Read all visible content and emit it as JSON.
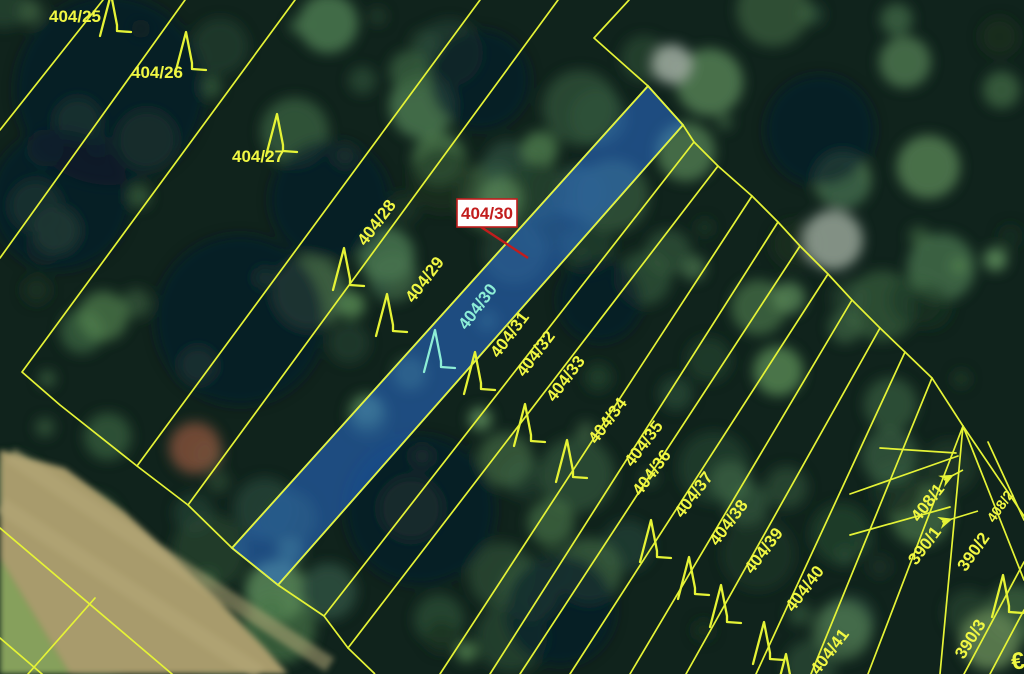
{
  "map": {
    "kind": "cadastral-parcel-overlay-on-aerial-imagery",
    "line_color": "#e5f336",
    "label_color": "#f0f743",
    "highlight_label_color": "#8deed6",
    "callout_color": "#c21d1d"
  },
  "callout": {
    "text": "404/30",
    "box": {
      "x": 457,
      "y": 199,
      "w": 60,
      "h": 28
    },
    "leader": [
      481,
      227,
      528,
      258
    ],
    "bg": "#ffffff",
    "border_color": "#c21d1d",
    "text_color": "#c21d1d"
  },
  "highlight_parcel": {
    "id": "404/30",
    "polygon": [
      [
        648,
        86
      ],
      [
        683,
        125
      ],
      [
        278,
        585
      ],
      [
        232,
        548
      ]
    ],
    "fill": "rgba(45,115,220,0.52)",
    "stroke": "#a8e4f0"
  },
  "parcel_labels": [
    {
      "text": "404/25",
      "x": 75,
      "y": 22,
      "rot": 0
    },
    {
      "text": "404/26",
      "x": 157,
      "y": 78,
      "rot": 0
    },
    {
      "text": "404/27",
      "x": 258,
      "y": 162,
      "rot": 0
    },
    {
      "text": "404/28",
      "x": 381,
      "y": 226,
      "rot": -53
    },
    {
      "text": "404/29",
      "x": 429,
      "y": 283,
      "rot": -53
    },
    {
      "text": "404/30",
      "x": 482,
      "y": 310,
      "rot": -53,
      "color": "#8deed6"
    },
    {
      "text": "404/31",
      "x": 514,
      "y": 338,
      "rot": -53
    },
    {
      "text": "404/32",
      "x": 540,
      "y": 357,
      "rot": -53
    },
    {
      "text": "404/33",
      "x": 570,
      "y": 382,
      "rot": -53
    },
    {
      "text": "404/34",
      "x": 612,
      "y": 424,
      "rot": -53
    },
    {
      "text": "404/35",
      "x": 648,
      "y": 447,
      "rot": -53
    },
    {
      "text": "404/36",
      "x": 656,
      "y": 476,
      "rot": -53
    },
    {
      "text": "404/37",
      "x": 698,
      "y": 498,
      "rot": -53
    },
    {
      "text": "404/38",
      "x": 733,
      "y": 526,
      "rot": -53
    },
    {
      "text": "404/39",
      "x": 768,
      "y": 554,
      "rot": -53
    },
    {
      "text": "404/40",
      "x": 809,
      "y": 592,
      "rot": -53
    },
    {
      "text": "404/41",
      "x": 834,
      "y": 655,
      "rot": -53
    },
    {
      "text": "408/1",
      "x": 932,
      "y": 506,
      "rot": -52
    },
    {
      "text": "408/2",
      "x": 1004,
      "y": 509,
      "rot": -55,
      "size": 14
    },
    {
      "text": "390/1",
      "x": 929,
      "y": 549,
      "rot": -53
    },
    {
      "text": "390/2",
      "x": 978,
      "y": 555,
      "rot": -55
    },
    {
      "text": "390/3",
      "x": 975,
      "y": 642,
      "rot": -58
    },
    {
      "text": "€",
      "x": 1019,
      "y": 669,
      "rot": -8,
      "size": 24
    }
  ],
  "lines": {
    "segments": [
      [
        103,
        0,
        0,
        130
      ],
      [
        185,
        0,
        0,
        258
      ],
      [
        295,
        0,
        22,
        372
      ],
      [
        480,
        0,
        137,
        466
      ],
      [
        558,
        0,
        188,
        505
      ],
      [
        629,
        0,
        594,
        38
      ],
      [
        648,
        86,
        232,
        548
      ],
      [
        683,
        125,
        278,
        585
      ],
      [
        694,
        142,
        324,
        616
      ],
      [
        718,
        166,
        348,
        648
      ],
      [
        752,
        196,
        440,
        674
      ],
      [
        778,
        222,
        490,
        674
      ],
      [
        800,
        246,
        520,
        674
      ],
      [
        828,
        274,
        570,
        674
      ],
      [
        852,
        300,
        630,
        674
      ],
      [
        880,
        328,
        686,
        674
      ],
      [
        905,
        352,
        756,
        674
      ],
      [
        932,
        378,
        811,
        674
      ],
      [
        963,
        426,
        868,
        674
      ],
      [
        880,
        448,
        956,
        453
      ],
      [
        850,
        494,
        958,
        456
      ],
      [
        850,
        535,
        950,
        507
      ],
      [
        963,
        426,
        940,
        674
      ],
      [
        963,
        426,
        1024,
        516
      ],
      [
        963,
        426,
        1024,
        580
      ],
      [
        988,
        442,
        1024,
        520
      ],
      [
        964,
        674,
        1024,
        562
      ],
      [
        990,
        674,
        1024,
        610
      ],
      [
        0,
        528,
        172,
        674
      ],
      [
        0,
        638,
        42,
        674
      ],
      [
        95,
        598,
        28,
        674
      ]
    ],
    "polylines": [
      [
        [
          594,
          38
        ],
        [
          648,
          86
        ],
        [
          683,
          125
        ],
        [
          694,
          142
        ],
        [
          718,
          166
        ],
        [
          752,
          196
        ],
        [
          778,
          222
        ],
        [
          800,
          246
        ],
        [
          828,
          274
        ],
        [
          852,
          300
        ],
        [
          880,
          328
        ],
        [
          905,
          352
        ],
        [
          932,
          378
        ],
        [
          963,
          426
        ]
      ],
      [
        [
          22,
          372
        ],
        [
          60,
          405
        ],
        [
          137,
          466
        ],
        [
          188,
          505
        ],
        [
          232,
          548
        ],
        [
          278,
          585
        ],
        [
          324,
          616
        ],
        [
          348,
          648
        ],
        [
          375,
          674
        ]
      ]
    ]
  },
  "tree_symbols": {
    "positions": [
      {
        "x": 100,
        "y": -8
      },
      {
        "x": 175,
        "y": 30
      },
      {
        "x": 266,
        "y": 112
      },
      {
        "x": 333,
        "y": 246
      },
      {
        "x": 376,
        "y": 292
      },
      {
        "x": 424,
        "y": 328,
        "hl": true
      },
      {
        "x": 464,
        "y": 350
      },
      {
        "x": 514,
        "y": 402
      },
      {
        "x": 556,
        "y": 438
      },
      {
        "x": 640,
        "y": 518
      },
      {
        "x": 678,
        "y": 555
      },
      {
        "x": 710,
        "y": 583
      },
      {
        "x": 753,
        "y": 620
      },
      {
        "x": 775,
        "y": 652
      },
      {
        "x": 992,
        "y": 573
      }
    ]
  },
  "arrows": [
    {
      "x1": 963,
      "y1": 470,
      "x2": 944,
      "y2": 480
    },
    {
      "x1": 978,
      "y1": 511,
      "x2": 942,
      "y2": 522
    }
  ],
  "terrain": {
    "base_color": "#10231c",
    "canopy_palette": [
      "#2a4b35",
      "#35593c",
      "#416845",
      "#4b7850",
      "#578853",
      "#24422e",
      "#1b3322",
      "#5e8d5c",
      "#38603f",
      "#2e5040"
    ],
    "dark_patches": [
      [
        110,
        90,
        95
      ],
      [
        60,
        200,
        70
      ],
      [
        240,
        320,
        85
      ],
      [
        330,
        200,
        60
      ],
      [
        420,
        510,
        75
      ],
      [
        560,
        610,
        55
      ],
      [
        820,
        130,
        55
      ],
      [
        600,
        300,
        42
      ],
      [
        480,
        80,
        50
      ]
    ],
    "field_polygon": [
      [
        0,
        450
      ],
      [
        65,
        468
      ],
      [
        125,
        512
      ],
      [
        175,
        558
      ],
      [
        220,
        602
      ],
      [
        265,
        648
      ],
      [
        288,
        674
      ],
      [
        70,
        674
      ],
      [
        0,
        558
      ]
    ],
    "field_color": "#a89b6c",
    "field_stripe_color": "#b5a878",
    "field_stripes": [
      [
        10,
        455,
        330,
        665
      ],
      [
        0,
        505,
        260,
        674
      ]
    ],
    "grass_polygon": [
      [
        0,
        558
      ],
      [
        70,
        674
      ],
      [
        0,
        674
      ]
    ],
    "grass_color": "#86a05c",
    "special_blobs": [
      [
        195,
        448,
        26,
        "#7a4e38"
      ],
      [
        672,
        64,
        20,
        "#9aa79b"
      ],
      [
        833,
        240,
        30,
        "#8f9c90"
      ],
      [
        905,
        62,
        26,
        "#49704a"
      ],
      [
        990,
        640,
        30,
        "#5e8051"
      ]
    ]
  }
}
